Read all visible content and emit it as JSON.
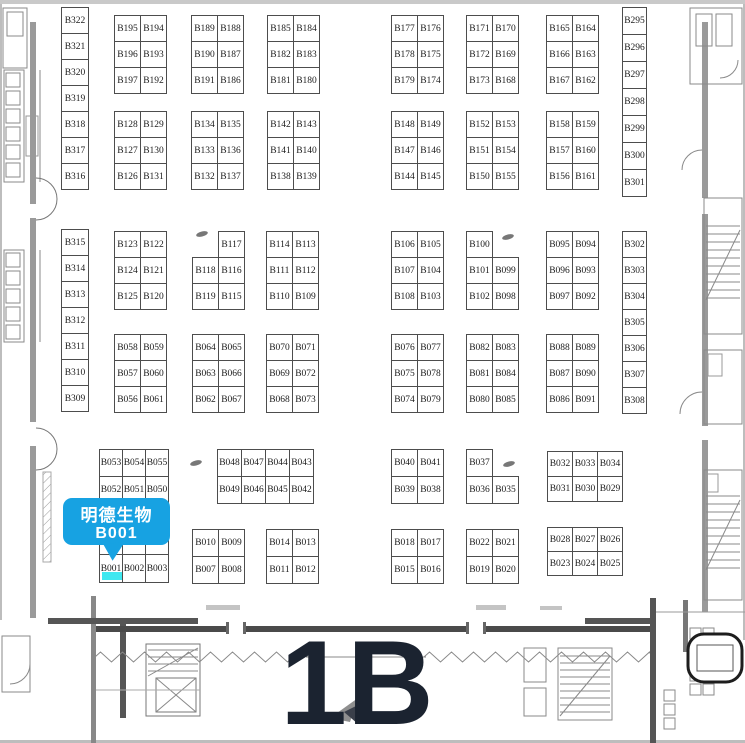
{
  "hall": {
    "label": "1B"
  },
  "callout": {
    "line1": "明德生物",
    "line2": "B001",
    "bg_color": "#17A2E2",
    "text_color": "#FFFFFF"
  },
  "highlight": {
    "booth": "B001",
    "color": "#3FE8F0"
  },
  "colors": {
    "booth_line": "#4d4d4d",
    "wall": "#9a9a9a",
    "heavy_wall": "#4a4a4a",
    "hall_text": "#1B2330"
  },
  "floorplan": {
    "blocks": [
      {
        "name": "col-b322",
        "x": 62,
        "y": 8,
        "cw": 28,
        "rows": [
          [
            "B322"
          ],
          [
            "B321"
          ],
          [
            "B320"
          ],
          [
            "B319"
          ],
          [
            "B318"
          ],
          [
            "B317"
          ],
          [
            "B316"
          ]
        ]
      },
      {
        "name": "blk-b195",
        "x": 115,
        "y": 16,
        "rows": [
          [
            "B195",
            "B194"
          ],
          [
            "B196",
            "B193"
          ],
          [
            "B197",
            "B192"
          ]
        ]
      },
      {
        "name": "blk-b189",
        "x": 192,
        "y": 16,
        "rows": [
          [
            "B189",
            "B188"
          ],
          [
            "B190",
            "B187"
          ],
          [
            "B191",
            "B186"
          ]
        ]
      },
      {
        "name": "blk-b185",
        "x": 268,
        "y": 16,
        "rows": [
          [
            "B185",
            "B184"
          ],
          [
            "B182",
            "B183"
          ],
          [
            "B181",
            "B180"
          ]
        ]
      },
      {
        "name": "blk-b177",
        "x": 392,
        "y": 16,
        "rows": [
          [
            "B177",
            "B176"
          ],
          [
            "B178",
            "B175"
          ],
          [
            "B179",
            "B174"
          ]
        ]
      },
      {
        "name": "blk-b171",
        "x": 467,
        "y": 16,
        "rows": [
          [
            "B171",
            "B170"
          ],
          [
            "B172",
            "B169"
          ],
          [
            "B173",
            "B168"
          ]
        ]
      },
      {
        "name": "blk-b165",
        "x": 547,
        "y": 16,
        "rows": [
          [
            "B165",
            "B164"
          ],
          [
            "B166",
            "B163"
          ],
          [
            "B167",
            "B162"
          ]
        ]
      },
      {
        "name": "col-b295",
        "x": 623,
        "y": 8,
        "cw": 25,
        "rh": [
          27,
          27,
          27,
          27,
          27,
          27,
          27
        ],
        "rows": [
          [
            "B295"
          ],
          [
            "B296"
          ],
          [
            "B297"
          ],
          [
            "B298"
          ],
          [
            "B299"
          ],
          [
            "B300"
          ],
          [
            "B301"
          ]
        ]
      },
      {
        "name": "blk-b128",
        "x": 115,
        "y": 112,
        "rows": [
          [
            "B128",
            "B129"
          ],
          [
            "B127",
            "B130"
          ],
          [
            "B126",
            "B131"
          ]
        ]
      },
      {
        "name": "blk-b134",
        "x": 192,
        "y": 112,
        "rows": [
          [
            "B134",
            "B135"
          ],
          [
            "B133",
            "B136"
          ],
          [
            "B132",
            "B137"
          ]
        ]
      },
      {
        "name": "blk-b142",
        "x": 268,
        "y": 112,
        "rows": [
          [
            "B142",
            "B143"
          ],
          [
            "B141",
            "B140"
          ],
          [
            "B138",
            "B139"
          ]
        ]
      },
      {
        "name": "blk-b148",
        "x": 392,
        "y": 112,
        "rows": [
          [
            "B148",
            "B149"
          ],
          [
            "B147",
            "B146"
          ],
          [
            "B144",
            "B145"
          ]
        ]
      },
      {
        "name": "blk-b152",
        "x": 467,
        "y": 112,
        "rows": [
          [
            "B152",
            "B153"
          ],
          [
            "B151",
            "B154"
          ],
          [
            "B150",
            "B155"
          ]
        ]
      },
      {
        "name": "blk-b158",
        "x": 547,
        "y": 112,
        "rows": [
          [
            "B158",
            "B159"
          ],
          [
            "B157",
            "B160"
          ],
          [
            "B156",
            "B161"
          ]
        ]
      },
      {
        "name": "col-b315",
        "x": 62,
        "y": 230,
        "cw": 28,
        "rows": [
          [
            "B315"
          ],
          [
            "B314"
          ],
          [
            "B313"
          ],
          [
            "B312"
          ],
          [
            "B311"
          ],
          [
            "B310"
          ],
          [
            "B309"
          ]
        ]
      },
      {
        "name": "blk-b123",
        "x": 115,
        "y": 232,
        "rows": [
          [
            "B123",
            "B122"
          ],
          [
            "B124",
            "B121"
          ],
          [
            "B125",
            "B120"
          ]
        ]
      },
      {
        "name": "blk-b117",
        "x": 193,
        "y": 232,
        "rows": [
          [
            null,
            "B117"
          ],
          [
            "B118",
            "B116"
          ],
          [
            "B119",
            "B115"
          ]
        ]
      },
      {
        "name": "blk-b114",
        "x": 267,
        "y": 232,
        "rows": [
          [
            "B114",
            "B113"
          ],
          [
            "B111",
            "B112"
          ],
          [
            "B110",
            "B109"
          ]
        ]
      },
      {
        "name": "blk-b106",
        "x": 392,
        "y": 232,
        "rows": [
          [
            "B106",
            "B105"
          ],
          [
            "B107",
            "B104"
          ],
          [
            "B108",
            "B103"
          ]
        ]
      },
      {
        "name": "blk-b100",
        "x": 467,
        "y": 232,
        "rows": [
          [
            "B100",
            null
          ],
          [
            "B101",
            "B099"
          ],
          [
            "B102",
            "B098"
          ]
        ]
      },
      {
        "name": "blk-b095",
        "x": 547,
        "y": 232,
        "rows": [
          [
            "B095",
            "B094"
          ],
          [
            "B096",
            "B093"
          ],
          [
            "B097",
            "B092"
          ]
        ]
      },
      {
        "name": "col-b302",
        "x": 623,
        "y": 232,
        "cw": 25,
        "rows": [
          [
            "B302"
          ],
          [
            "B303"
          ],
          [
            "B304"
          ],
          [
            "B305"
          ],
          [
            "B306"
          ],
          [
            "B307"
          ],
          [
            "B308"
          ]
        ]
      },
      {
        "name": "blk-b058",
        "x": 115,
        "y": 335,
        "rows": [
          [
            "B058",
            "B059"
          ],
          [
            "B057",
            "B060"
          ],
          [
            "B056",
            "B061"
          ]
        ]
      },
      {
        "name": "blk-b064",
        "x": 193,
        "y": 335,
        "rows": [
          [
            "B064",
            "B065"
          ],
          [
            "B063",
            "B066"
          ],
          [
            "B062",
            "B067"
          ]
        ]
      },
      {
        "name": "blk-b070",
        "x": 267,
        "y": 335,
        "rows": [
          [
            "B070",
            "B071"
          ],
          [
            "B069",
            "B072"
          ],
          [
            "B068",
            "B073"
          ]
        ]
      },
      {
        "name": "blk-b076",
        "x": 392,
        "y": 335,
        "rows": [
          [
            "B076",
            "B077"
          ],
          [
            "B075",
            "B078"
          ],
          [
            "B074",
            "B079"
          ]
        ]
      },
      {
        "name": "blk-b082",
        "x": 467,
        "y": 335,
        "rows": [
          [
            "B082",
            "B083"
          ],
          [
            "B081",
            "B084"
          ],
          [
            "B080",
            "B085"
          ]
        ]
      },
      {
        "name": "blk-b088",
        "x": 547,
        "y": 335,
        "rows": [
          [
            "B088",
            "B089"
          ],
          [
            "B087",
            "B090"
          ],
          [
            "B086",
            "B091"
          ]
        ]
      },
      {
        "name": "blk-b053",
        "x": 100,
        "y": 450,
        "cw": 24,
        "rh": [
          27,
          27,
          51,
          28
        ],
        "rows": [
          [
            "B053",
            "B054",
            "B055"
          ],
          [
            "B052",
            "B051",
            "B050"
          ],
          [
            "",
            "",
            ""
          ],
          [
            "B001",
            "B002",
            "B003"
          ]
        ]
      },
      {
        "name": "blk-b048",
        "x": 218,
        "y": 450,
        "cw": 25,
        "rh": [
          27,
          27
        ],
        "rows": [
          [
            "B048",
            "B047",
            "B044",
            "B043"
          ],
          [
            "B049",
            "B046",
            "B045",
            "B042"
          ]
        ]
      },
      {
        "name": "blk-b040",
        "x": 392,
        "y": 450,
        "rh": [
          27,
          27
        ],
        "rows": [
          [
            "B040",
            "B041"
          ],
          [
            "B039",
            "B038"
          ]
        ]
      },
      {
        "name": "blk-b037",
        "x": 467,
        "y": 450,
        "rh": [
          27,
          27
        ],
        "rows": [
          [
            "B037",
            null
          ],
          [
            "B036",
            "B035"
          ]
        ]
      },
      {
        "name": "blk-b032",
        "x": 548,
        "y": 452,
        "cw": 26,
        "rh": [
          25,
          25
        ],
        "rows": [
          [
            "B032",
            "B033",
            "B034"
          ],
          [
            "B031",
            "B030",
            "B029"
          ]
        ]
      },
      {
        "name": "blk-b010",
        "x": 193,
        "y": 530,
        "rh": [
          27,
          27
        ],
        "rows": [
          [
            "B010",
            "B009"
          ],
          [
            "B007",
            "B008"
          ]
        ]
      },
      {
        "name": "blk-b014",
        "x": 267,
        "y": 530,
        "rh": [
          27,
          27
        ],
        "rows": [
          [
            "B014",
            "B013"
          ],
          [
            "B011",
            "B012"
          ]
        ]
      },
      {
        "name": "blk-b018",
        "x": 392,
        "y": 530,
        "rh": [
          27,
          27
        ],
        "rows": [
          [
            "B018",
            "B017"
          ],
          [
            "B015",
            "B016"
          ]
        ]
      },
      {
        "name": "blk-b022",
        "x": 467,
        "y": 530,
        "rh": [
          27,
          27
        ],
        "rows": [
          [
            "B022",
            "B021"
          ],
          [
            "B019",
            "B020"
          ]
        ]
      },
      {
        "name": "blk-b028",
        "x": 548,
        "y": 528,
        "cw": 26,
        "rh": [
          24,
          24
        ],
        "rows": [
          [
            "B028",
            "B027",
            "B026"
          ],
          [
            "B023",
            "B024",
            "B025"
          ]
        ]
      }
    ]
  }
}
